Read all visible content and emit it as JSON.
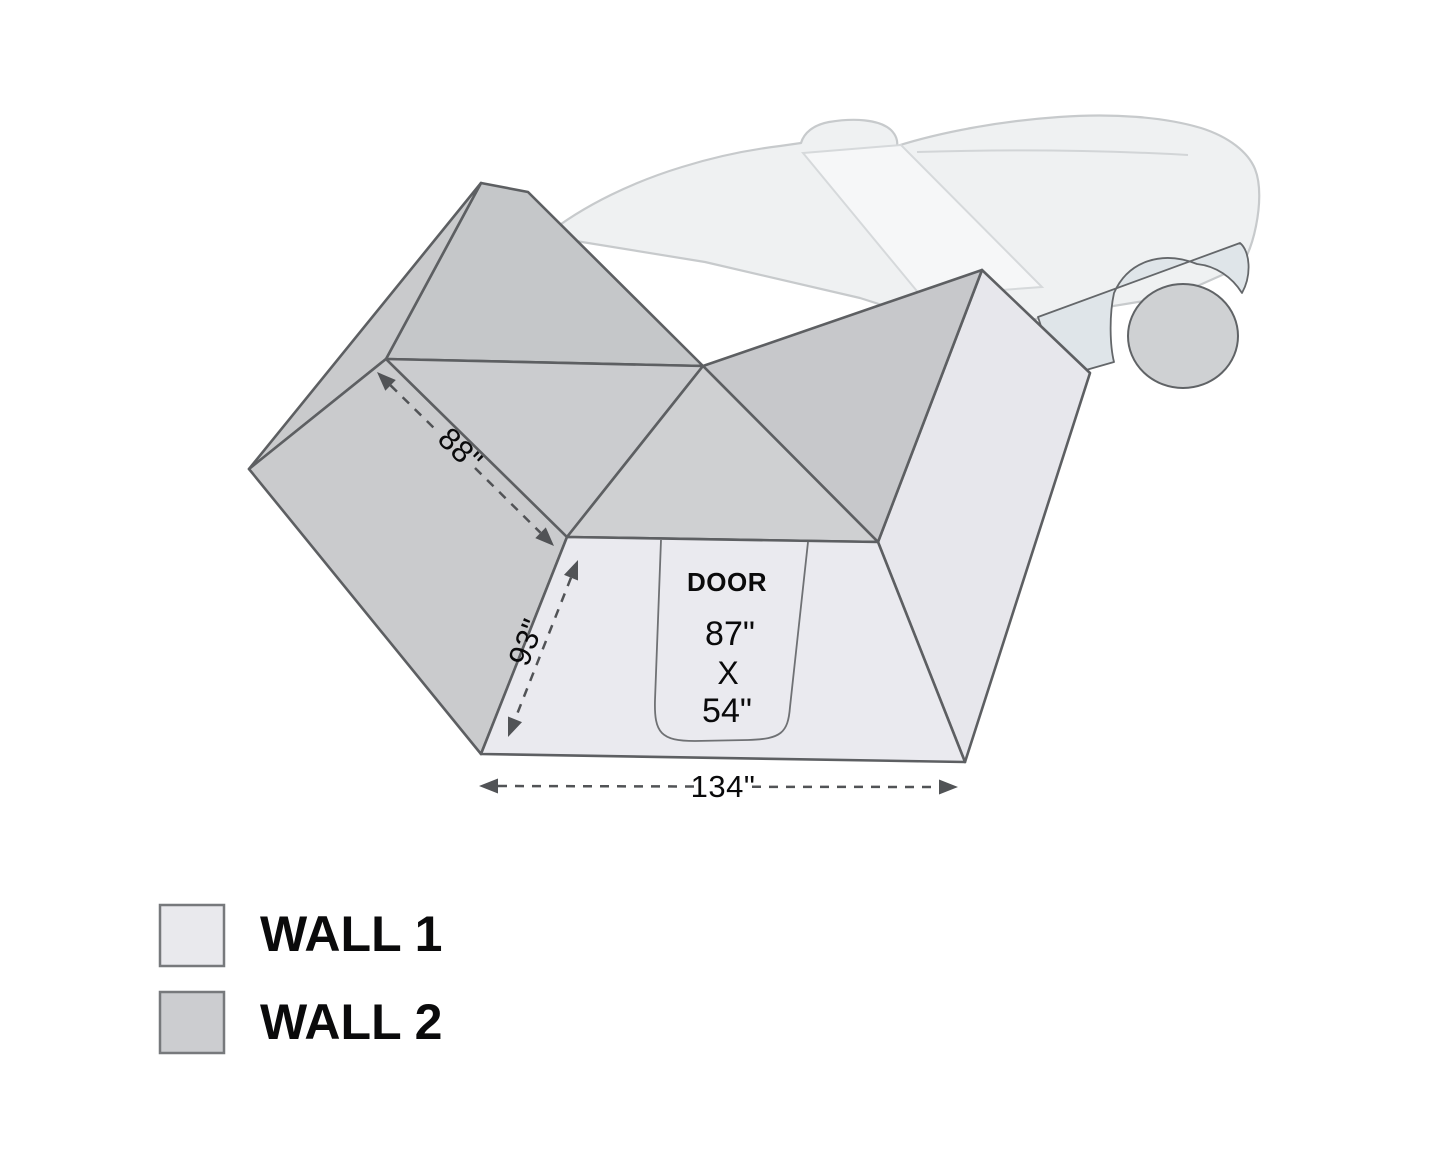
{
  "door": {
    "label": "DOOR",
    "height": "87\"",
    "times": "X",
    "width": "54\""
  },
  "dimensions": {
    "back_edge": "88\"",
    "side_edge": "93\"",
    "front_width": "134\""
  },
  "legend": {
    "items": [
      {
        "id": "wall-1",
        "label": "WALL 1",
        "color": "#e9e9ed"
      },
      {
        "id": "wall-2",
        "label": "WALL 2",
        "color": "#cccdd0"
      }
    ]
  },
  "colors": {
    "wall1_front": "#eaeaef",
    "wall1_right": "#e7e7ec",
    "wall2_back_band": "#c9cacc",
    "wall2_ridge": "#c5c7c9",
    "wall2_left_wall": "#cacbcd",
    "wall2_roof_left": "#cbcccf",
    "wall2_roof_front": "#cfd0d2",
    "wall2_roof_right": "#c7c8cb",
    "outline": "#5d5f62",
    "door_line": "#6f7174",
    "dimension": "#515356",
    "text": "#0a0a0b",
    "car_body": "#eff1f2",
    "car_body_line": "#c7cacc",
    "car_glass": "#f6f7f8",
    "car_fender": "#dfe5e9",
    "car_wheel": "#cfd1d3"
  }
}
